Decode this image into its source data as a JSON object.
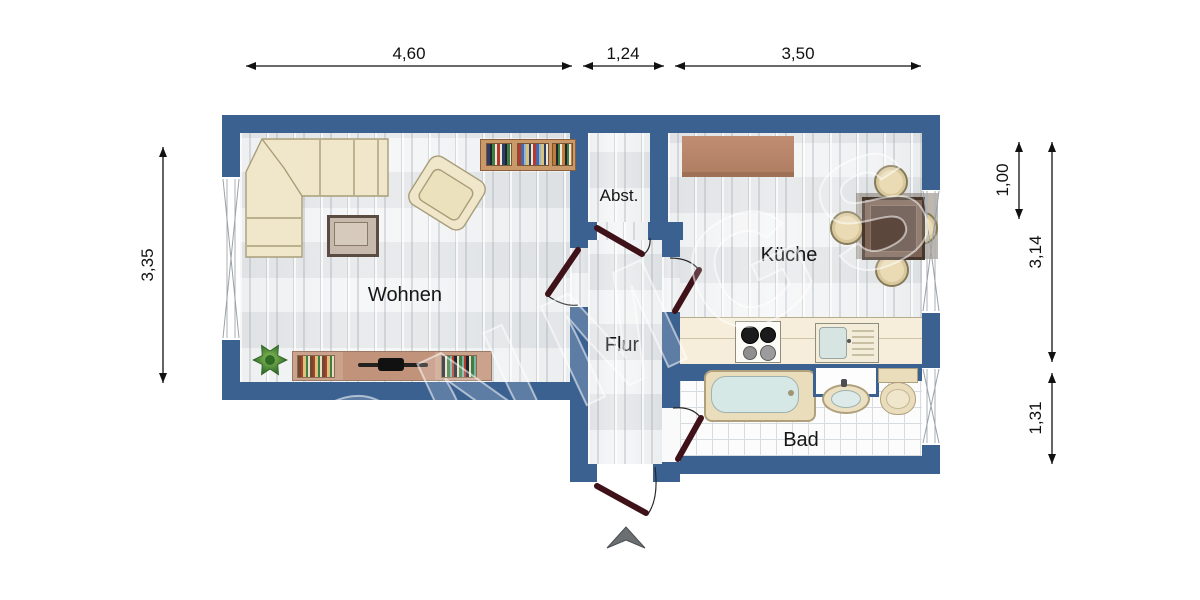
{
  "floorplan": {
    "labels": {
      "wohnen": "Wohnen",
      "abst": "Abst.",
      "kueche": "Küche",
      "flur": "Flur",
      "bad": "Bad"
    },
    "dimensions": {
      "top": [
        "4,60",
        "1,24",
        "3,50"
      ],
      "left": [
        "3,35"
      ],
      "right": [
        "1,00",
        "3,14",
        "1,31"
      ]
    },
    "watermark": "ONMGS",
    "colors": {
      "wall": "#3b6190",
      "door_leaf": "#3f1118",
      "dimension_text": "#111111"
    },
    "furniture": [
      "corner-sofa",
      "armchair",
      "coffee-table",
      "wall-bookshelf",
      "plant",
      "tv-lowboard",
      "kitchen-sideboard",
      "dining-table",
      "dining-chair",
      "kitchen-counter",
      "stove",
      "kitchen-sink",
      "bathtub",
      "washbasin",
      "toilet",
      "mirror-cabinet",
      "entrance-arrow"
    ]
  }
}
